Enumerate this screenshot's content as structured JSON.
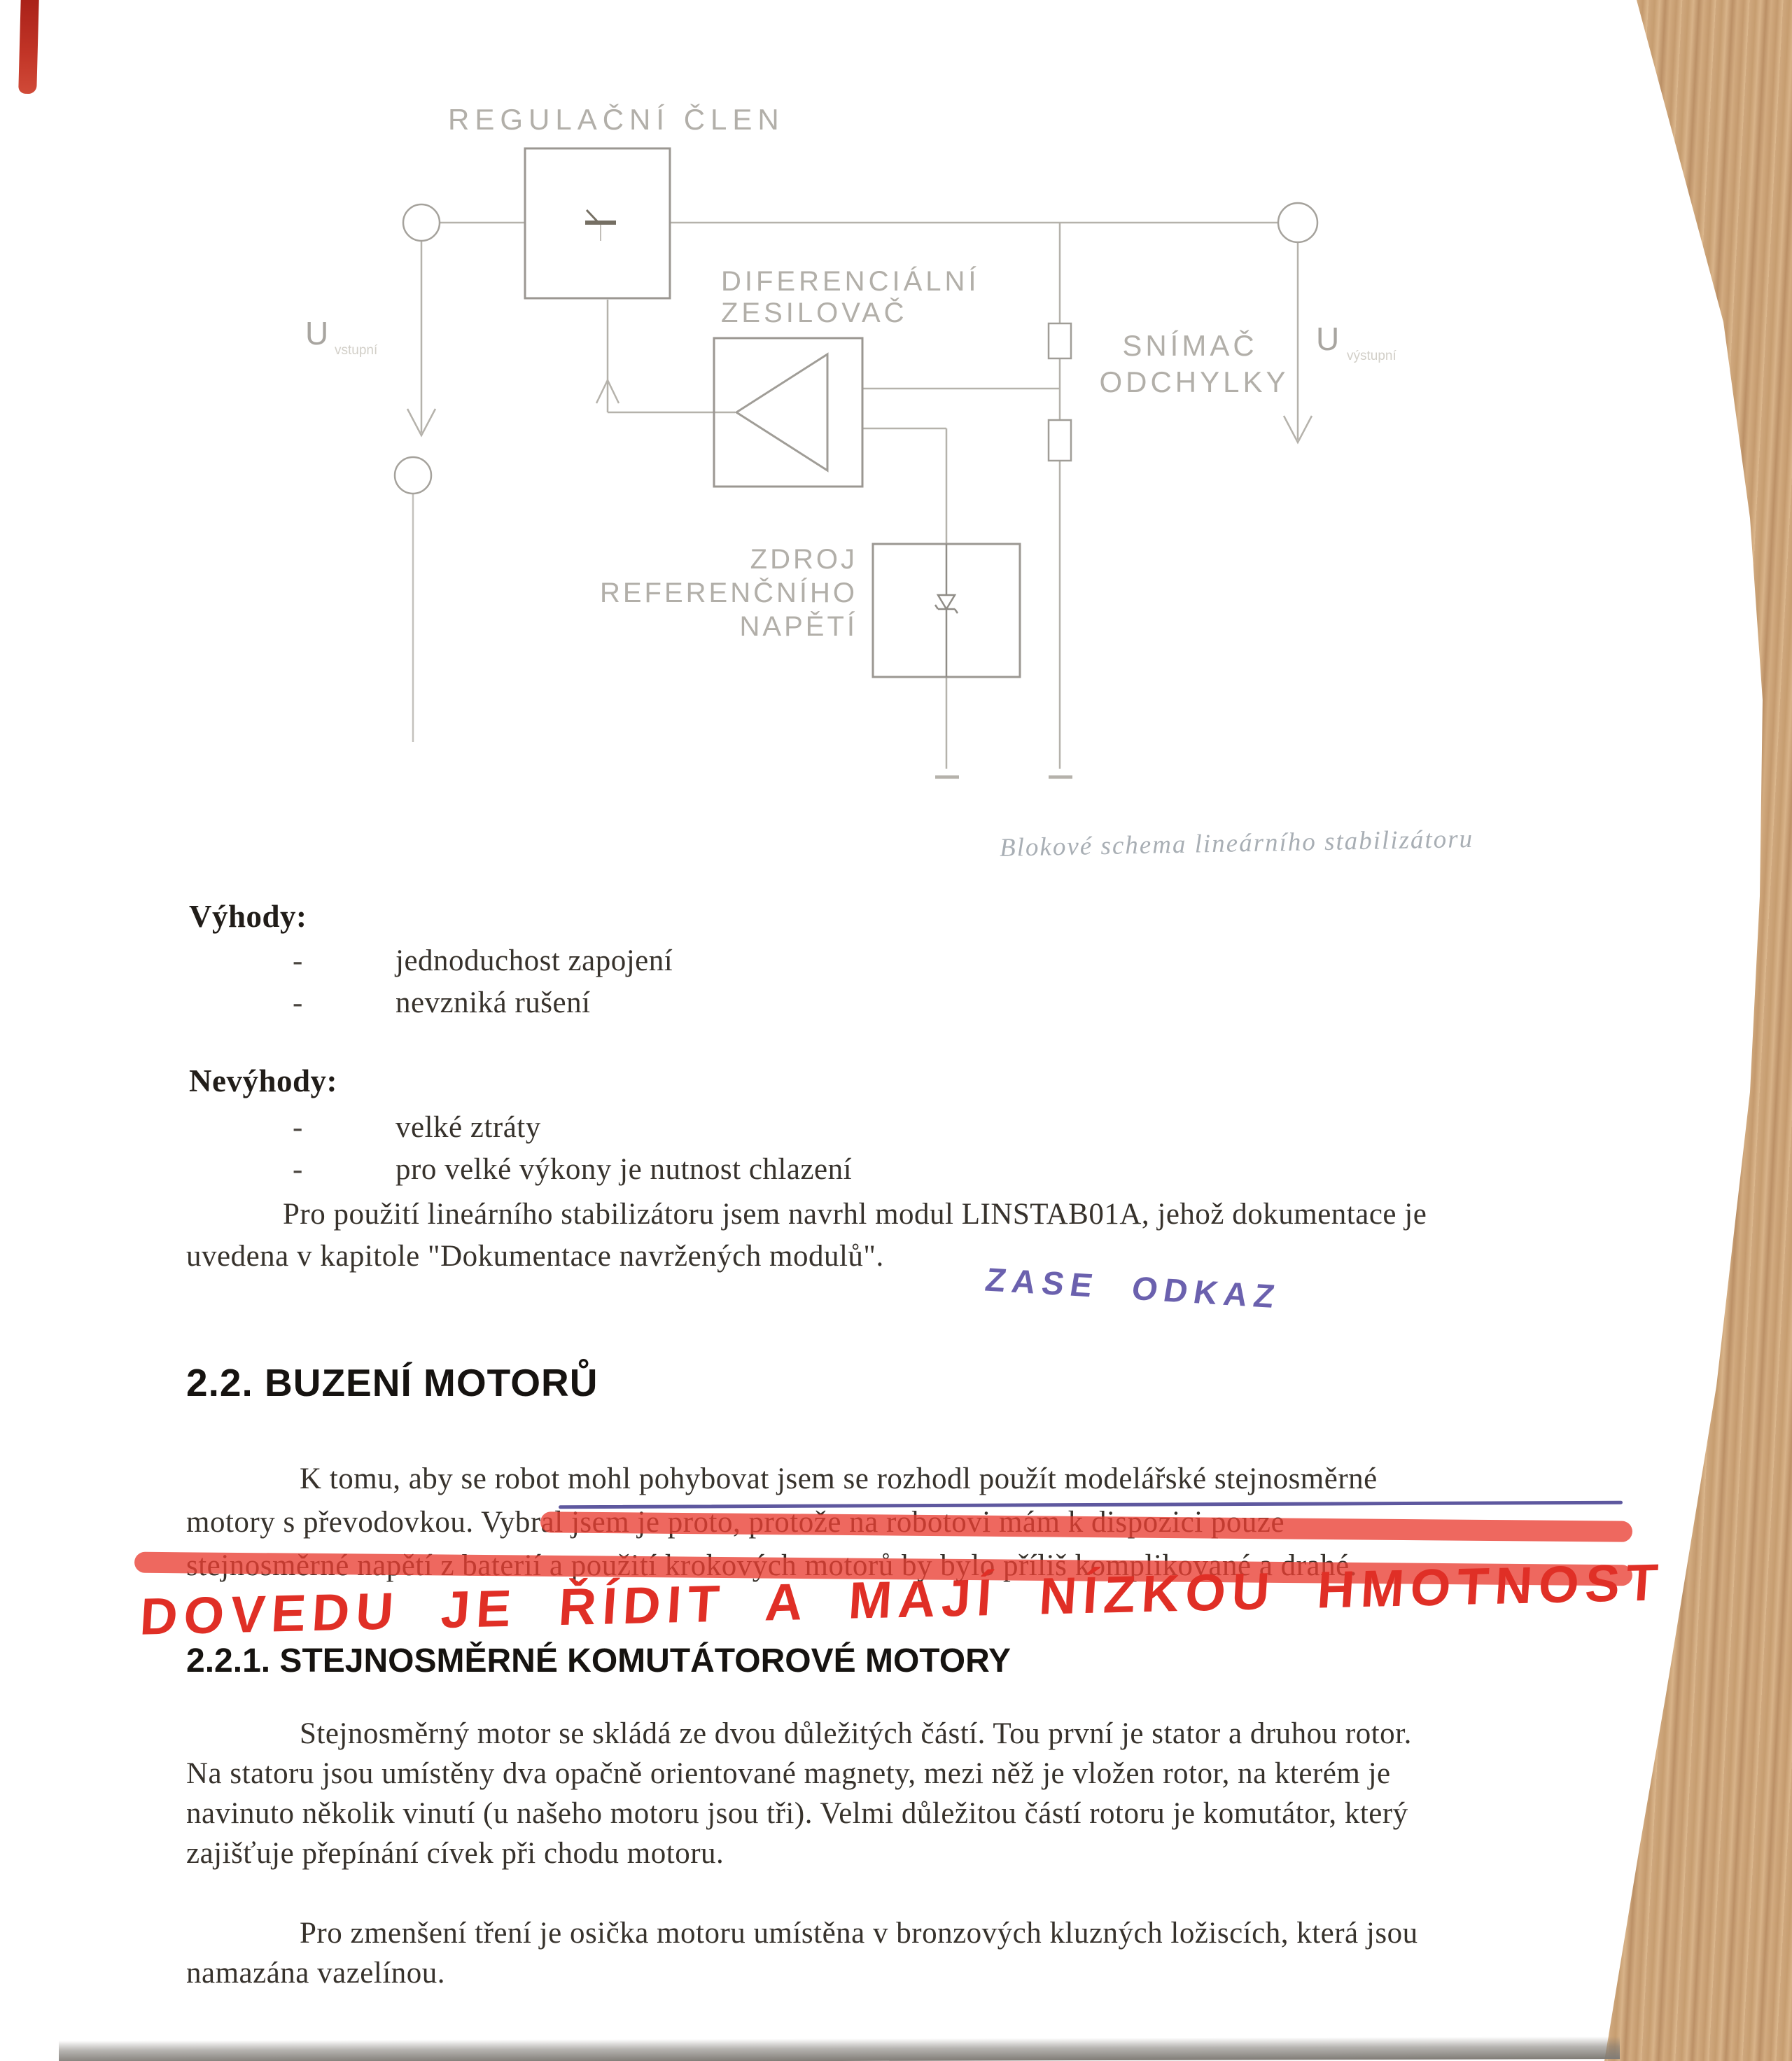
{
  "diagram": {
    "labels": {
      "regulator": "REGULAČNÍ ČLEN",
      "diff_amp_line1": "DIFERENCIÁLNÍ",
      "diff_amp_line2": "ZESILOVAČ",
      "sensor_line1": "SNÍMAČ",
      "sensor_line2": "ODCHYLKY",
      "ref_line1": "ZDROJ",
      "ref_line2": "REFERENČNÍHO",
      "ref_line3": "NAPĚTÍ",
      "u_in": "U",
      "u_in_sub": "vstupní",
      "u_out": "U",
      "u_out_sub": "výstupní"
    },
    "caption": "Blokové schema lineárního stabilizátoru"
  },
  "advantages": {
    "title": "Výhody:",
    "bullet": "-",
    "items": [
      "jednoduchost zapojení",
      "nevzniká rušení"
    ]
  },
  "disadvantages": {
    "title": "Nevýhody:",
    "bullet": "-",
    "items": [
      "velké ztráty",
      "pro velké výkony je nutnost chlazení"
    ]
  },
  "paragraph_linstab": {
    "line1": "Pro použití lineárního stabilizátoru jsem navrhl modul LINSTAB01A, jehož dokumentace je",
    "line2": "uvedena v kapitole \"Dokumentace navržených modulů\"."
  },
  "handwriting": {
    "blue_note": "ZASE ODKAZ",
    "red_note": "DOVEDU JE ŘÍDIT A MAJÍ NÍZKOU HMOTNOST",
    "blue_color": "#5b51a6",
    "red_color": "#e02f26"
  },
  "section_2_2": {
    "heading": "2.2. BUZENÍ MOTORŮ",
    "para": {
      "line1": "K tomu, aby se robot mohl pohybovat jsem se rozhodl použít modelářské stejnosměrné",
      "line2": "motory s převodovkou. Vybral jsem je proto, protože na robotovi mám k dispozici pouze",
      "line3": "stejnosměrné napětí z baterií a použití krokových motorů by bylo příliš komplikované a drahé."
    }
  },
  "section_2_2_1": {
    "heading": "2.2.1. STEJNOSMĚRNÉ KOMUTÁTOROVÉ MOTORY",
    "para1": {
      "line1": "Stejnosměrný motor se skládá ze dvou důležitých částí. Tou první je stator a druhou rotor.",
      "line2": "Na statoru jsou umístěny dva opačně orientované magnety, mezi něž je vložen rotor, na kterém je",
      "line3": "navinuto několik vinutí (u našeho motoru jsou tři). Velmi důležitou částí rotoru je komutátor, který",
      "line4": "zajišťuje přepínání cívek při chodu motoru."
    },
    "para2": {
      "line1": "Pro zmenšení tření je osička motoru umístěna v bronzových kluzných ložiscích, která jsou",
      "line2": "namazána vazelínou."
    }
  }
}
